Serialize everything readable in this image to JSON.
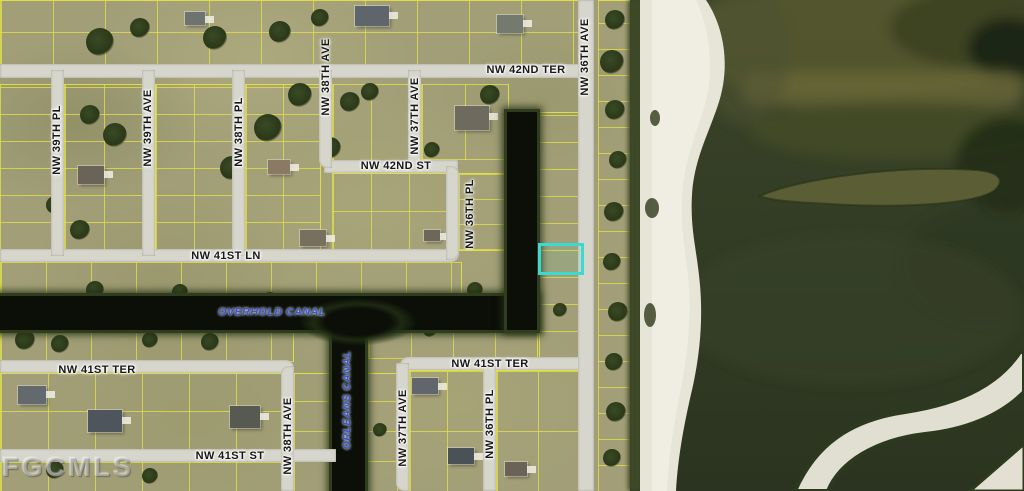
{
  "map": {
    "type": "aerial-parcel-map",
    "watermark": "FGCMLS",
    "colors": {
      "highlight": "#3bd9d1",
      "street_label": "#161616",
      "canal_label": "#3d55c8",
      "road": "#d7d6cd",
      "lot_line": "#e2e048",
      "canal_water": "#0b0f08",
      "lake_water": "#333d25",
      "sand": "#e7e4d8",
      "land": "#a29f78"
    },
    "highlighted_parcel": {
      "x": 538,
      "y": 243,
      "width": 40,
      "height": 26
    },
    "street_labels": [
      {
        "text": "NW 42ND TER",
        "orientation": "horizontal",
        "x": 526,
        "y": 70
      },
      {
        "text": "NW 42ND ST",
        "orientation": "horizontal",
        "x": 396,
        "y": 166
      },
      {
        "text": "NW 41ST LN",
        "orientation": "horizontal",
        "x": 226,
        "y": 256
      },
      {
        "text": "NW 41ST TER",
        "orientation": "horizontal",
        "x": 97,
        "y": 370
      },
      {
        "text": "NW 41ST TER",
        "orientation": "horizontal",
        "x": 490,
        "y": 364
      },
      {
        "text": "NW 41ST ST",
        "orientation": "horizontal",
        "x": 230,
        "y": 456
      },
      {
        "text": "NW 39TH PL",
        "orientation": "vertical",
        "x": 57,
        "y": 140
      },
      {
        "text": "NW 39TH AVE",
        "orientation": "vertical",
        "x": 148,
        "y": 128
      },
      {
        "text": "NW 38TH PL",
        "orientation": "vertical",
        "x": 239,
        "y": 132
      },
      {
        "text": "NW 38TH AVE",
        "orientation": "vertical",
        "x": 326,
        "y": 77
      },
      {
        "text": "NW 37TH AVE",
        "orientation": "vertical",
        "x": 415,
        "y": 116
      },
      {
        "text": "NW 36TH PL",
        "orientation": "vertical",
        "x": 470,
        "y": 214
      },
      {
        "text": "NW 36TH AVE",
        "orientation": "vertical",
        "x": 585,
        "y": 57
      },
      {
        "text": "NW 37TH AVE",
        "orientation": "vertical",
        "x": 403,
        "y": 428
      },
      {
        "text": "NW 36TH PL",
        "orientation": "vertical",
        "x": 490,
        "y": 424
      },
      {
        "text": "NW 38TH AVE",
        "orientation": "vertical",
        "x": 288,
        "y": 436
      }
    ],
    "canal_labels": [
      {
        "text": "OVERHOLD CANAL",
        "orientation": "horizontal",
        "x": 272,
        "y": 312
      },
      {
        "text": "ORLEANS CANAL",
        "orientation": "vertical",
        "x": 347,
        "y": 400
      }
    ],
    "houses": [
      {
        "x": 355,
        "y": 6,
        "w": 34,
        "h": 20,
        "roof": "#5f666b"
      },
      {
        "x": 497,
        "y": 15,
        "w": 26,
        "h": 18,
        "roof": "#757a6f"
      },
      {
        "x": 185,
        "y": 12,
        "w": 20,
        "h": 13,
        "roof": "#6e7370"
      },
      {
        "x": 78,
        "y": 166,
        "w": 26,
        "h": 18,
        "roof": "#6a6458"
      },
      {
        "x": 300,
        "y": 230,
        "w": 26,
        "h": 16,
        "roof": "#77705f"
      },
      {
        "x": 424,
        "y": 230,
        "w": 16,
        "h": 11,
        "roof": "#6d675a"
      },
      {
        "x": 455,
        "y": 106,
        "w": 34,
        "h": 24,
        "roof": "#6e6a5e"
      },
      {
        "x": 412,
        "y": 378,
        "w": 26,
        "h": 16,
        "roof": "#60666b"
      },
      {
        "x": 18,
        "y": 386,
        "w": 28,
        "h": 18,
        "roof": "#636a6e"
      },
      {
        "x": 88,
        "y": 410,
        "w": 34,
        "h": 22,
        "roof": "#4e555c"
      },
      {
        "x": 230,
        "y": 406,
        "w": 30,
        "h": 22,
        "roof": "#565a50"
      },
      {
        "x": 448,
        "y": 448,
        "w": 26,
        "h": 16,
        "roof": "#4a5258"
      },
      {
        "x": 505,
        "y": 462,
        "w": 22,
        "h": 14,
        "roof": "#6b6257"
      },
      {
        "x": 268,
        "y": 160,
        "w": 22,
        "h": 14,
        "roof": "#8a7a64"
      }
    ],
    "trees": [
      {
        "x": 100,
        "y": 42,
        "r": 14
      },
      {
        "x": 140,
        "y": 28,
        "r": 10
      },
      {
        "x": 215,
        "y": 38,
        "r": 12
      },
      {
        "x": 280,
        "y": 32,
        "r": 11
      },
      {
        "x": 320,
        "y": 18,
        "r": 9
      },
      {
        "x": 90,
        "y": 115,
        "r": 10
      },
      {
        "x": 115,
        "y": 135,
        "r": 12
      },
      {
        "x": 80,
        "y": 230,
        "r": 10
      },
      {
        "x": 300,
        "y": 95,
        "r": 12
      },
      {
        "x": 268,
        "y": 128,
        "r": 14
      },
      {
        "x": 232,
        "y": 168,
        "r": 12
      },
      {
        "x": 350,
        "y": 102,
        "r": 10
      },
      {
        "x": 330,
        "y": 148,
        "r": 11
      },
      {
        "x": 370,
        "y": 92,
        "r": 9
      },
      {
        "x": 490,
        "y": 95,
        "r": 10
      },
      {
        "x": 432,
        "y": 150,
        "r": 8
      },
      {
        "x": 55,
        "y": 205,
        "r": 9
      },
      {
        "x": 25,
        "y": 340,
        "r": 10
      },
      {
        "x": 60,
        "y": 344,
        "r": 9
      },
      {
        "x": 150,
        "y": 340,
        "r": 8
      },
      {
        "x": 210,
        "y": 342,
        "r": 9
      },
      {
        "x": 270,
        "y": 300,
        "r": 8
      },
      {
        "x": 95,
        "y": 290,
        "r": 9
      },
      {
        "x": 180,
        "y": 292,
        "r": 8
      },
      {
        "x": 475,
        "y": 290,
        "r": 8
      },
      {
        "x": 55,
        "y": 470,
        "r": 9
      },
      {
        "x": 150,
        "y": 476,
        "r": 8
      },
      {
        "x": 615,
        "y": 20,
        "r": 10
      },
      {
        "x": 612,
        "y": 62,
        "r": 12
      },
      {
        "x": 615,
        "y": 110,
        "r": 10
      },
      {
        "x": 618,
        "y": 160,
        "r": 9
      },
      {
        "x": 614,
        "y": 212,
        "r": 10
      },
      {
        "x": 612,
        "y": 262,
        "r": 9
      },
      {
        "x": 618,
        "y": 312,
        "r": 10
      },
      {
        "x": 614,
        "y": 362,
        "r": 9
      },
      {
        "x": 616,
        "y": 412,
        "r": 10
      },
      {
        "x": 612,
        "y": 458,
        "r": 9
      },
      {
        "x": 380,
        "y": 430,
        "r": 7
      },
      {
        "x": 560,
        "y": 310,
        "r": 7
      },
      {
        "x": 430,
        "y": 330,
        "r": 7
      }
    ]
  }
}
